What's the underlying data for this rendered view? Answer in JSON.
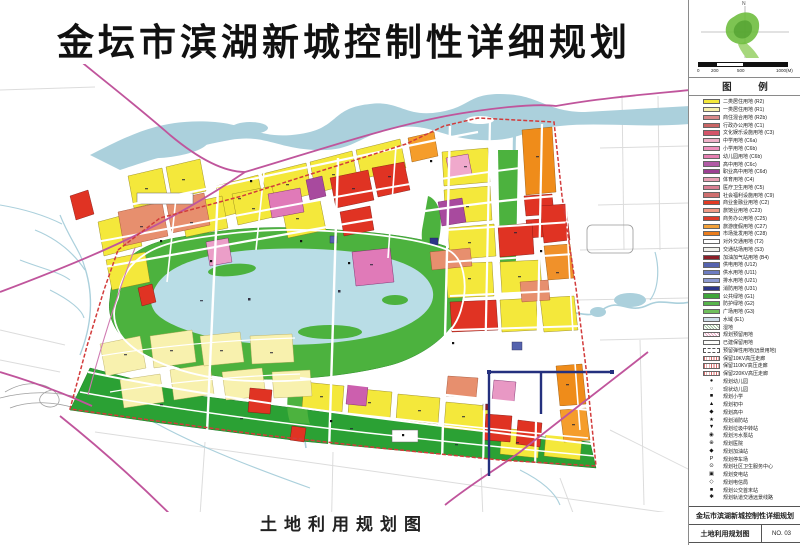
{
  "page": {
    "title": "金坛市滨湖新城控制性详细规划",
    "map_caption": "土地利用规划图"
  },
  "north_panel": {
    "north_label": "N",
    "scale_ticks": [
      "0",
      "200",
      "500",
      "1000(M)"
    ]
  },
  "legend": {
    "header": "图  例",
    "items": [
      {
        "kind": "color",
        "color": "#f4e83b",
        "label": "二类居住用地 (R2)"
      },
      {
        "kind": "color",
        "color": "#f8f1ae",
        "label": "一类居住用地 (R1)"
      },
      {
        "kind": "color",
        "color": "#d98a8a",
        "label": "商住混合用地 (R2b)"
      },
      {
        "kind": "color",
        "color": "#c96464",
        "label": "行政办公用地 (C1)"
      },
      {
        "kind": "color",
        "color": "#d4556a",
        "label": "文化娱乐设施用地 (C3)"
      },
      {
        "kind": "color",
        "color": "#efb1c8",
        "label": "中学用地 (C6a)"
      },
      {
        "kind": "color",
        "color": "#ee8fbc",
        "label": "小学用地 (C6b)"
      },
      {
        "kind": "color",
        "color": "#e67fb2",
        "label": "幼儿园用地 (C6b)"
      },
      {
        "kind": "color",
        "color": "#b15ba5",
        "label": "高中用地 (C6c)"
      },
      {
        "kind": "color",
        "color": "#9c3f92",
        "label": "职业高中用地 (C6d)"
      },
      {
        "kind": "color",
        "color": "#e8a0b4",
        "label": "体育用地 (C4)"
      },
      {
        "kind": "color",
        "color": "#d97f93",
        "label": "医疗卫生用地 (C5)"
      },
      {
        "kind": "color",
        "color": "#cf6f6f",
        "label": "社会福利设施用地 (C9)"
      },
      {
        "kind": "color",
        "color": "#e23a23",
        "label": "商业金融业用地 (C2)"
      },
      {
        "kind": "color",
        "color": "#ef9a86",
        "label": "旅馆业用地 (C23)"
      },
      {
        "kind": "color",
        "color": "#dd3b2a",
        "label": "商务办公用地 (C25)"
      },
      {
        "kind": "color",
        "color": "#f3a23a",
        "label": "旅游度假用地 (C27)"
      },
      {
        "kind": "color",
        "color": "#ea7c1c",
        "label": "市场批发用地 (C28)"
      },
      {
        "kind": "white",
        "color": "#ffffff",
        "label": "对外交通用地 (T2)"
      },
      {
        "kind": "white",
        "color": "#f2f2ec",
        "label": "交通站场用地 (S3)"
      },
      {
        "kind": "color",
        "color": "#8c1f28",
        "label": "加油加气站用地 (B4)"
      },
      {
        "kind": "color",
        "color": "#5563ae",
        "label": "供电用地 (U12)"
      },
      {
        "kind": "color",
        "color": "#6d7cc0",
        "label": "供水用地 (U11)"
      },
      {
        "kind": "color",
        "color": "#8d9ad0",
        "label": "排水用地 (U21)"
      },
      {
        "kind": "color",
        "color": "#2c3587",
        "label": "消防用地 (U31)"
      },
      {
        "kind": "color",
        "color": "#3fa53a",
        "label": "公共绿地 (G1)"
      },
      {
        "kind": "color",
        "color": "#57b54b",
        "label": "防护绿地 (G2)"
      },
      {
        "kind": "color",
        "color": "#6fbf5c",
        "label": "广场用地 (G3)"
      },
      {
        "kind": "color",
        "color": "#cfe0ea",
        "label": "水域 (E1)"
      },
      {
        "kind": "hatchgreen",
        "label": "湿地"
      },
      {
        "kind": "hatchpink",
        "label": "规划预留用地"
      },
      {
        "kind": "white",
        "label": "已建保留用地"
      },
      {
        "kind": "dash",
        "label": "预留弹性用地(远景用地)"
      },
      {
        "kind": "hatchred",
        "label": "保留10KV高压走廊"
      },
      {
        "kind": "hatchred",
        "label": "保留110KV高压走廊"
      },
      {
        "kind": "hatchred",
        "label": "保留220KV高压走廊"
      },
      {
        "kind": "symbol",
        "glyph": "●",
        "label": "规划幼儿园"
      },
      {
        "kind": "symbol",
        "glyph": "○",
        "label": "现状幼儿园"
      },
      {
        "kind": "symbol",
        "glyph": "■",
        "label": "规划小学"
      },
      {
        "kind": "symbol",
        "glyph": "▲",
        "label": "规划初中"
      },
      {
        "kind": "symbol",
        "glyph": "◆",
        "label": "规划高中"
      },
      {
        "kind": "symbol",
        "glyph": "★",
        "label": "规划消防站"
      },
      {
        "kind": "symbol",
        "glyph": "▼",
        "label": "规划垃圾中转站"
      },
      {
        "kind": "symbol",
        "glyph": "◉",
        "label": "规划污水泵站"
      },
      {
        "kind": "symbol",
        "glyph": "⊕",
        "label": "规划医院"
      },
      {
        "kind": "symbol",
        "glyph": "◆",
        "label": "规划加油站"
      },
      {
        "kind": "symbol",
        "glyph": "P",
        "label": "规划停车场"
      },
      {
        "kind": "symbol",
        "glyph": "⊙",
        "label": "规划社区卫生服务中心"
      },
      {
        "kind": "symbol",
        "glyph": "▣",
        "label": "规划变电站"
      },
      {
        "kind": "symbol",
        "glyph": "◇",
        "label": "规划电信局"
      },
      {
        "kind": "symbol",
        "glyph": "■",
        "label": "规划公交首末站"
      },
      {
        "kind": "symbol",
        "glyph": "✱",
        "label": "规划轨道交通远景线路"
      }
    ]
  },
  "title_block": {
    "project": "金坛市滨湖新城控制性详细规划",
    "drawing": "土地利用规划图",
    "number": "NO. 03"
  },
  "colors": {
    "residential_yellow": "#f4e83b",
    "villa_pale_yellow": "#f8f1ae",
    "commercial_red": "#e23a23",
    "market_orange": "#ef8c1a",
    "school_magenta": "#d86fb4",
    "park_green": "#4cb23e",
    "buffer_green": "#2ba134",
    "lake_blue": "#b9dde6",
    "river_blue": "#abd0dc",
    "boundary_red": "#d23b3b",
    "main_road_magenta": "#c0559c",
    "regulation_navy": "#24307e"
  }
}
